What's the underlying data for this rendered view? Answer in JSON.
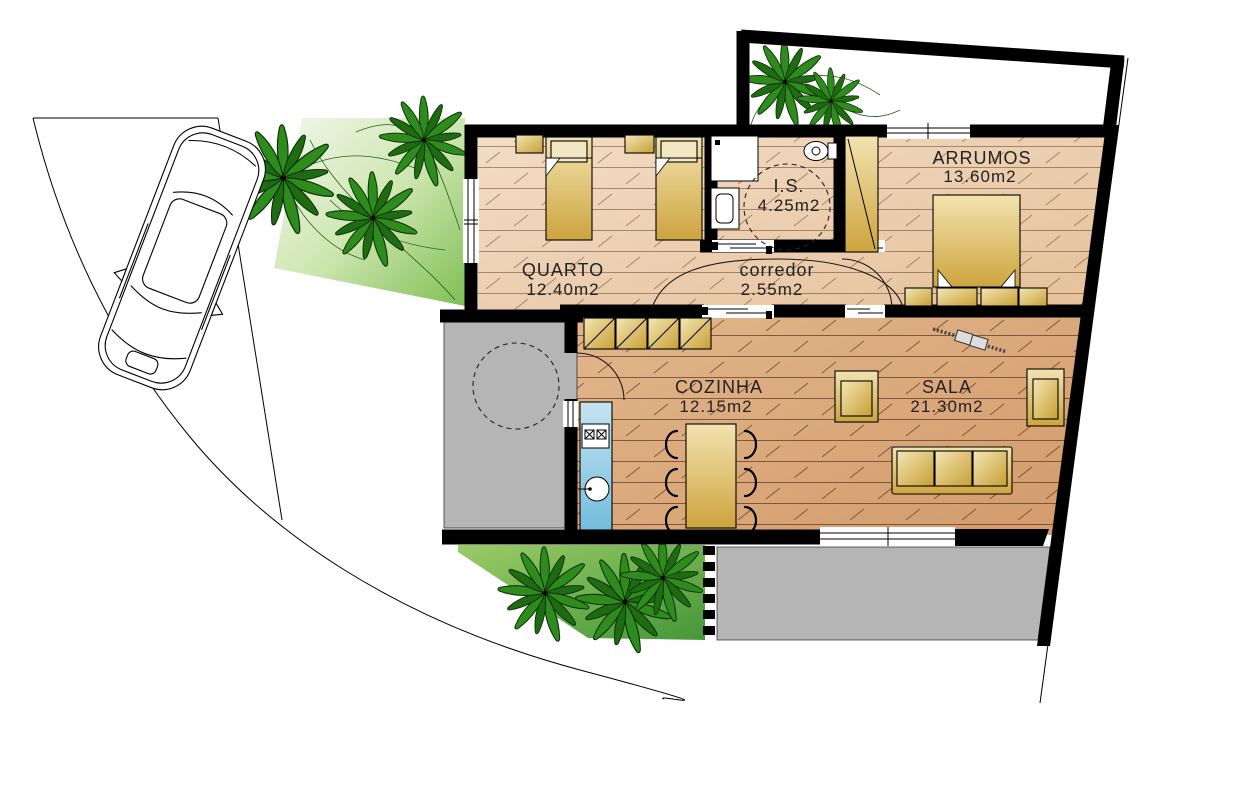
{
  "theme": {
    "wall_color": "#000000",
    "floor_light": "#ecd0b2",
    "floor_dark": "#d9a87c",
    "furniture_gold": "#d9b355",
    "counter_blue": "#8fcbe4",
    "patio_gray": "#b5b5b5",
    "lawn_green": "#6fb445",
    "palm_green": "#2e8c1d",
    "palm_green_dark": "#1e6b12",
    "label_color": "#222222"
  },
  "rooms": [
    {
      "id": "quarto",
      "name": "QUARTO",
      "area": "12.40m2"
    },
    {
      "id": "is",
      "name": "I.S.",
      "area": "4.25m2"
    },
    {
      "id": "corredor",
      "name": "corredor",
      "area": "2.55m2"
    },
    {
      "id": "arrumos",
      "name": "ARRUMOS",
      "area": "13.60m2"
    },
    {
      "id": "cozinha",
      "name": "COZINHA",
      "area": "12.15m2"
    },
    {
      "id": "sala",
      "name": "SALA",
      "area": "21.30m2"
    }
  ],
  "objects": [
    "car",
    "palm-tree",
    "single-bed",
    "double-bed",
    "nightstand",
    "wardrobe",
    "sofa",
    "armchair",
    "dining-table",
    "dining-chair",
    "kitchen-counter",
    "stove",
    "sink",
    "upper-cabinets",
    "toilet",
    "washbasin",
    "shower",
    "ceiling-fan",
    "deck-posts",
    "turning-circle",
    "lawn",
    "patio",
    "courtyard"
  ]
}
